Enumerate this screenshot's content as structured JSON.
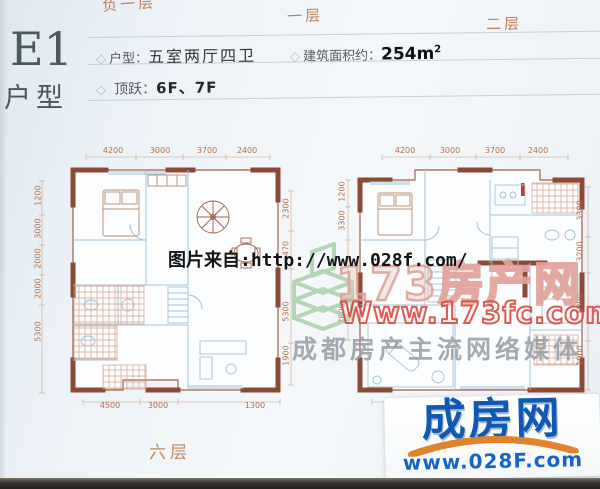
{
  "tabs": [
    {
      "label": "负一层"
    },
    {
      "label": "一层"
    },
    {
      "label": "二层"
    }
  ],
  "header": {
    "code": "E1",
    "type_label": "户型"
  },
  "info": {
    "bullet": "◇",
    "layout_label": "户型：",
    "layout_value": "五室两厅四卫",
    "area_label": "建筑面积约：",
    "area_value": "254m",
    "area_sup": "2",
    "duplex_label": "顶跃：",
    "duplex_value": "6F、7F"
  },
  "plans": {
    "left": {
      "floor_label": "六层",
      "dims_top": [
        "4200",
        "3000",
        "3700",
        "2400"
      ],
      "dims_left": [
        "1200",
        "3000",
        "2000",
        "2000",
        "5300"
      ],
      "dims_right": [
        "2300",
        "470",
        "5300",
        "1900"
      ],
      "dims_bottom": [
        "4500",
        "3000",
        "1300"
      ]
    },
    "right": {
      "dims_top": [
        "4200",
        "3000",
        "3700",
        "2400"
      ],
      "dims_left": [
        "1200",
        "3300",
        "7800"
      ],
      "dims_right": [
        "3300",
        "3200",
        "5300",
        "1900"
      ],
      "dims_bottom": [
        "4500"
      ]
    }
  },
  "watermarks": {
    "source_line": "图片来自:http://www.028f.com/",
    "brand_name": "173房产网",
    "brand_url": "Www.173fc.com",
    "brand_slogan": "成都房产主流网络媒体"
  },
  "logo": {
    "name": "成房网",
    "url": "www.028F.com"
  },
  "colors": {
    "tab_orange": "#c4805a",
    "wall_brown": "#8a4a36",
    "plan_blue": "#a3c0d8",
    "hatch_pink": "#dca28b",
    "brand_red": "#d73e34",
    "brand_green": "#a8d2a8",
    "logo_blue": "#0e5ab2",
    "logo_orange": "#e0832c"
  }
}
